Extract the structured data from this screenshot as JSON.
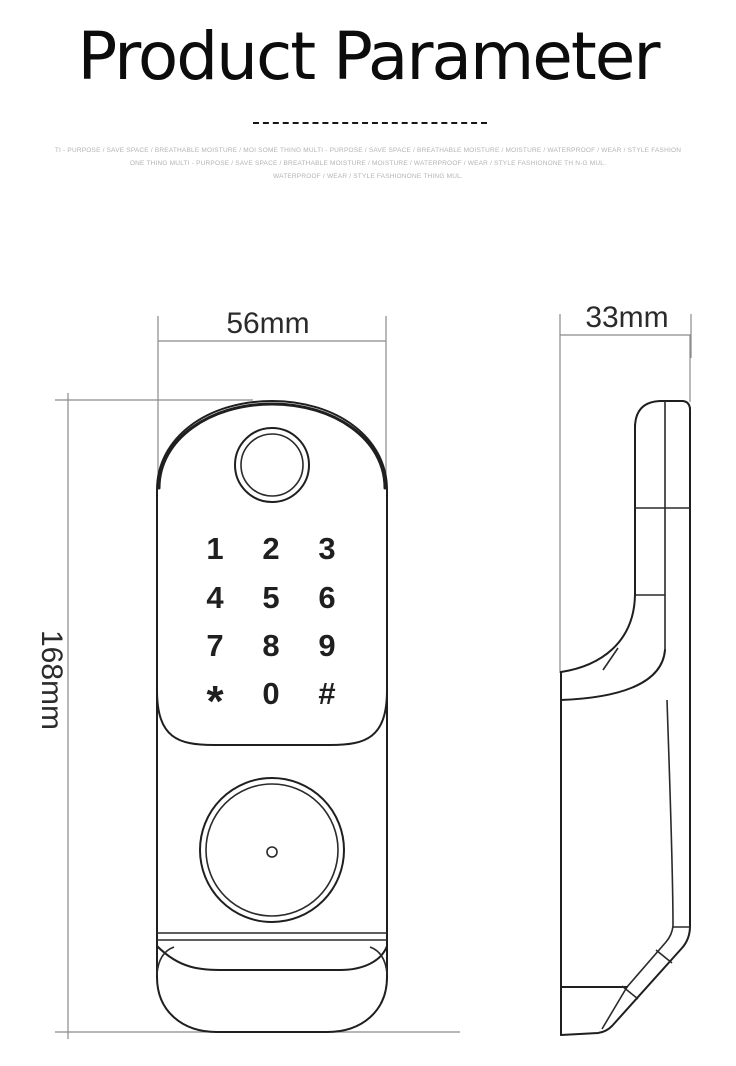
{
  "header": {
    "title": "Product Parameter",
    "tagline_lines": [
      "TI - PURPOSE / SAVE SPACE / BREATHABLE MOISTURE / MOI SOME THING MULTI - PURPOSE / SAVE SPACE / BREATHABLE MOISTURE / MOISTURE / WATERPROOF / WEAR / STYLE FASHION",
      "ONE THING MULTI - PURPOSE / SAVE SPACE / BREATHABLE MOISTURE / MOISTURE / WATERPROOF / WEAR / STYLE FASHIONONE TH N-G MUL.",
      "WATERPROOF / WEAR / STYLE FASHIONONE THING MUL."
    ]
  },
  "diagram": {
    "front_view": {
      "width_label": "56mm",
      "height_label": "168mm",
      "keypad_keys": [
        "1",
        "2",
        "3",
        "4",
        "5",
        "6",
        "7",
        "8",
        "9",
        "*",
        "0",
        "#"
      ]
    },
    "side_view": {
      "depth_label": "33mm"
    }
  },
  "colors": {
    "line": "#1f1f1f",
    "dimension_line": "#8a8a8a",
    "label_text": "#2b2b2b",
    "tagline_text": "#b3b3b3",
    "background": "#ffffff"
  }
}
